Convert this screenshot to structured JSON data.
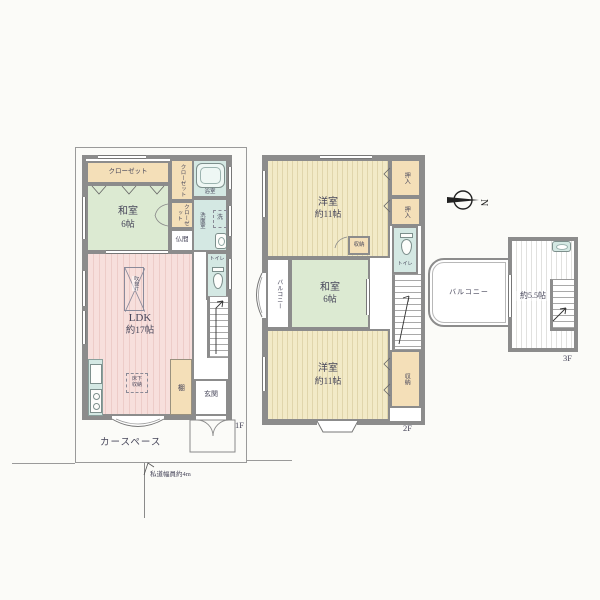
{
  "labels": {
    "floor1": "1F",
    "floor2": "2F",
    "floor3": "3F"
  },
  "compass": {
    "north": "N"
  },
  "site": {
    "car_space": "カースペース",
    "road_width_note": "私道幅員約4m"
  },
  "floor1": {
    "closet_wide": "クローゼット",
    "closet_upper": "クローゼット",
    "closet_lower": "クローゼット",
    "washitsu_name": "和室",
    "washitsu_size": "6帖",
    "bath": "浴室",
    "washroom": "洗面室",
    "washer": "洗",
    "butsuma": "仏間",
    "toilet": "トイレ",
    "ldk_name": "LDK",
    "ldk_size": "約17帖",
    "void_note": "吹抜け",
    "floor_storage": "床下収納",
    "shelf": "棚",
    "genkan": "玄関"
  },
  "floor2": {
    "yoshitsu_top_name": "洋室",
    "yoshitsu_top_size": "約11帖",
    "oshiire_1": "押入",
    "oshiire_2": "押入",
    "toilet": "トイレ",
    "storage_mid_upper": "収納",
    "balcony": "バルコニー",
    "washitsu_name": "和室",
    "washitsu_size": "6帖",
    "storage_mid_lower": "収納",
    "yoshitsu_bottom_name": "洋室",
    "yoshitsu_bottom_size": "約11帖",
    "storage_right": "収納"
  },
  "floor3": {
    "room_size": "約5.5帖",
    "balcony": "バルコニー"
  },
  "colors": {
    "wall": "#8c8c8c",
    "tatami_green": "#dcead2",
    "wood_pink": "#f7dfdc",
    "wood_cream": "#f2eac7",
    "wet_teal": "#d4e8e3",
    "storage_tan": "#f4dfb8"
  }
}
